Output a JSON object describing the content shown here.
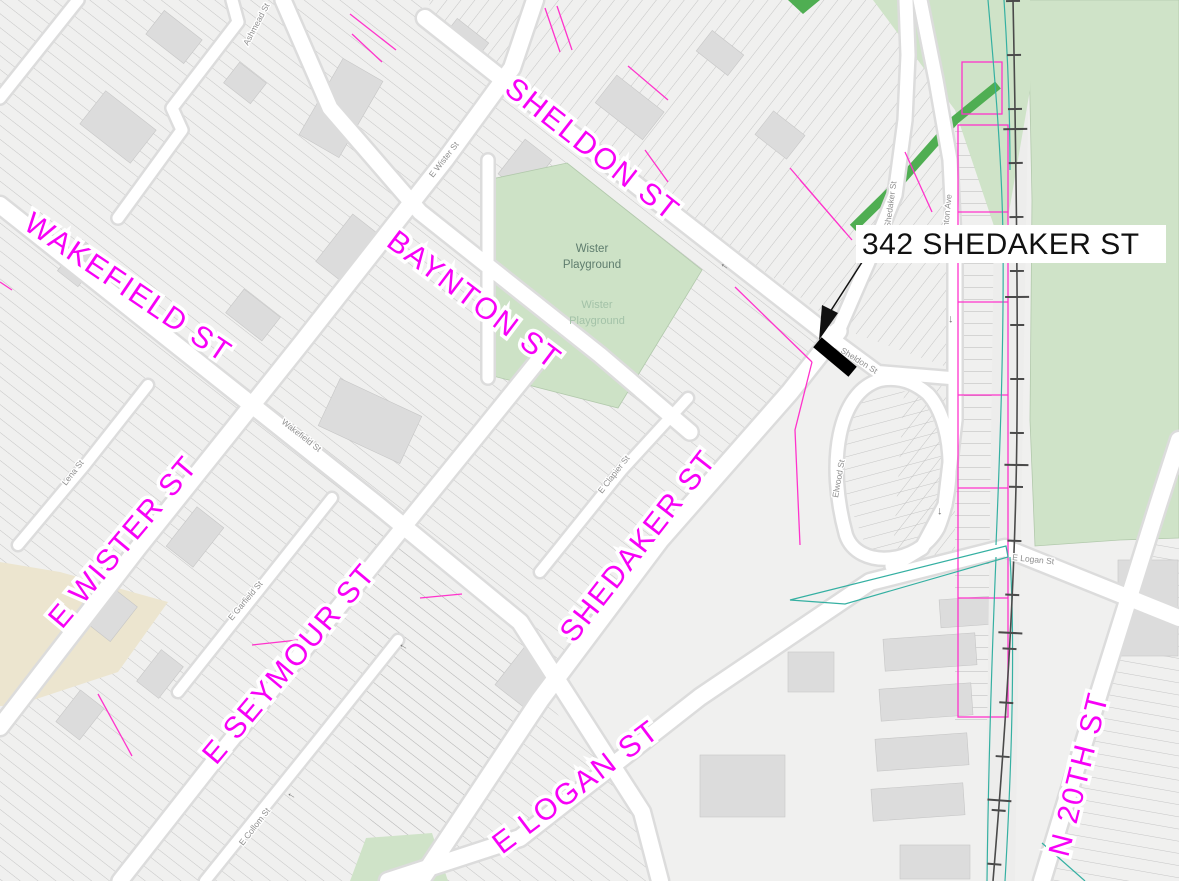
{
  "annotation": {
    "address_label": "342 SHEDAKER ST"
  },
  "street_labels": {
    "sheldon": {
      "text": "SHELDON ST"
    },
    "wakefield": {
      "text": "WAKEFIELD ST"
    },
    "baynton": {
      "text": "BAYNTON ST"
    },
    "e_wister": {
      "text": "E WISTER ST"
    },
    "e_seymour": {
      "text": "E SEYMOUR ST"
    },
    "shedaker": {
      "text": "SHEDAKER ST"
    },
    "e_logan": {
      "text": "E LOGAN ST"
    },
    "n_20th": {
      "text": "N 20TH ST"
    }
  },
  "minor_labels": {
    "e_wister_st": {
      "text": "E Wister St"
    },
    "wakefield_st": {
      "text": "Wakefield St"
    },
    "sheldon_st": {
      "text": "Sheldon St"
    },
    "shedaker_st": {
      "text": "Shedaker St"
    },
    "stenton_ave": {
      "text": "Stenton Ave"
    },
    "elwood_st": {
      "text": "Elwood St"
    },
    "e_logan_st": {
      "text": "E Logan St"
    },
    "lena_st": {
      "text": "Lena St"
    },
    "e_garfield_st": {
      "text": "E Garfield St"
    },
    "e_collom_st": {
      "text": "E Collom St"
    },
    "e_clapier_st": {
      "text": "E Clapier St"
    },
    "ashmead_st": {
      "text": "Ashmead St"
    }
  },
  "poi": {
    "playground_line1": "Wister",
    "playground_line2": "Playground",
    "playground_faint_line1": "Wister",
    "playground_faint_line2": "Playground"
  },
  "icons": {
    "one_way_arrow": "→"
  },
  "colors": {
    "street_label_magenta": "#f700f7",
    "parcel_magenta": "#ff33cc",
    "park_green_light": "#cde2c6",
    "open_space_green": "#cfe3c8",
    "vegetation_dark_green": "#4fae52",
    "utility_teal": "#35b0a2",
    "railroad_gray": "#4a4a4a",
    "minor_label_gray": "#8f8f8f",
    "annotation_black": "#111111",
    "highlight_marker_black": "#000000",
    "beige_area": "#ece5cf"
  }
}
